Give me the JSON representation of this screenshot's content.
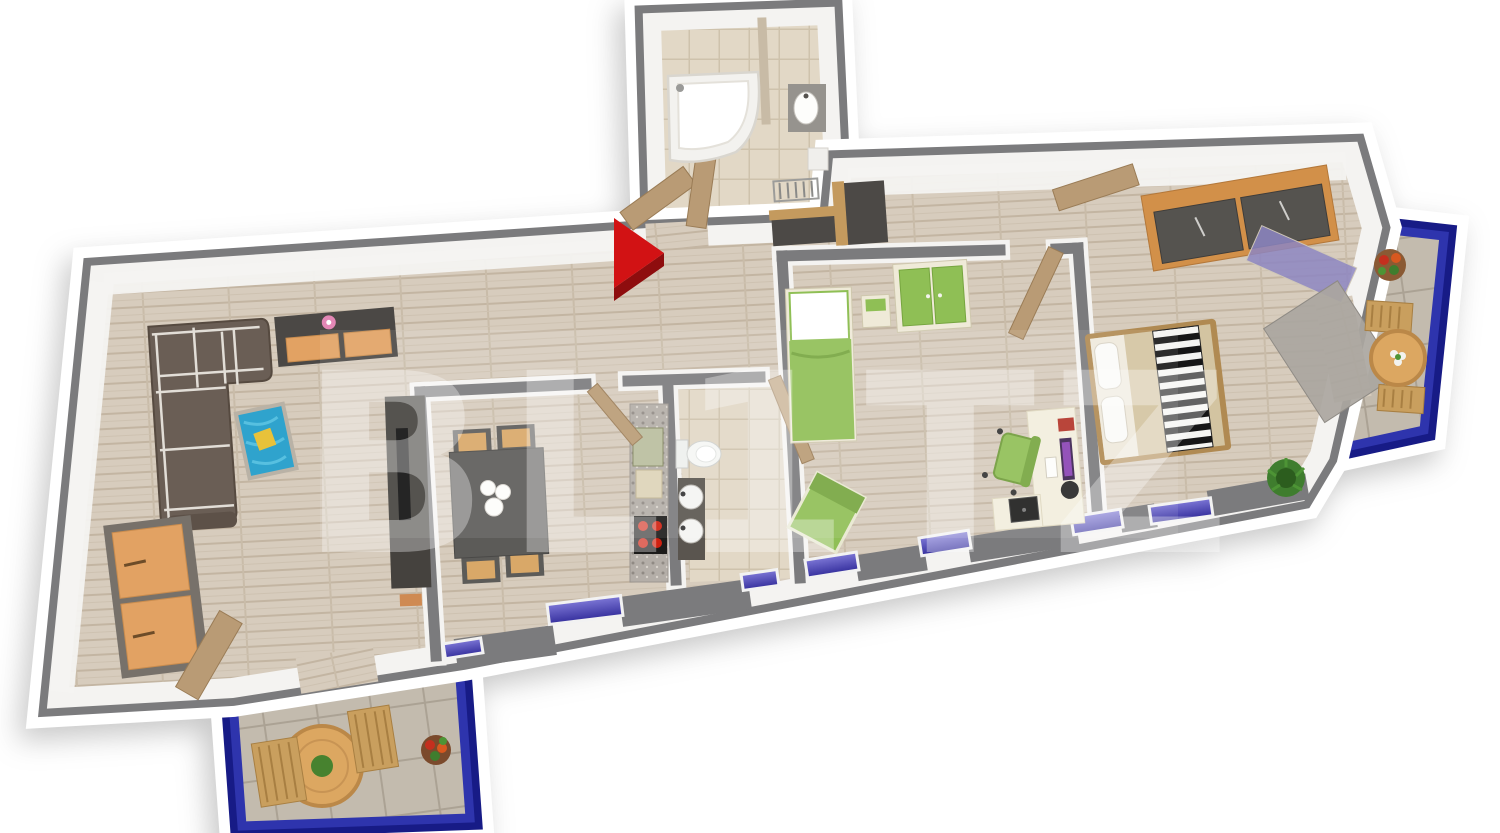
{
  "watermark": {
    "text": "BL1TZ",
    "opacity": "0.33"
  },
  "entrance": {
    "marker": "entrance-arrow"
  },
  "palette": {
    "background": "#ffffff",
    "wall_gray": "#7b7b7d",
    "wall_face_white": "#f4f3f1",
    "wood_floor": "#d7ccbd",
    "tile_beige": "#e2d8c6",
    "tile_gray": "#c3bbae",
    "balcony_railing_blue": "#171b86",
    "balcony_railing_light": "#2e34ad",
    "window_glass_blue": "#4f49b4",
    "furniture_green": "#8fbf55",
    "furniture_green_dark": "#76a53f",
    "furniture_orange": "#e2a263",
    "sofa_brown": "#6a5e55",
    "rug_blue": "#2fa3cd",
    "pillow_yellow": "#e8c23a",
    "wood_door": "#b99b75",
    "wood_warm": "#d29049",
    "dark_furniture": "#4b4845",
    "granite": "#b4aea8",
    "stove_red": "#cf2010",
    "arrow_red": "#d21214",
    "arrow_red_dark": "#8e0d0e",
    "flower_pink": "#e387b5",
    "plant_green": "#3f7d2e",
    "bed_beige": "#d3c4a1"
  }
}
